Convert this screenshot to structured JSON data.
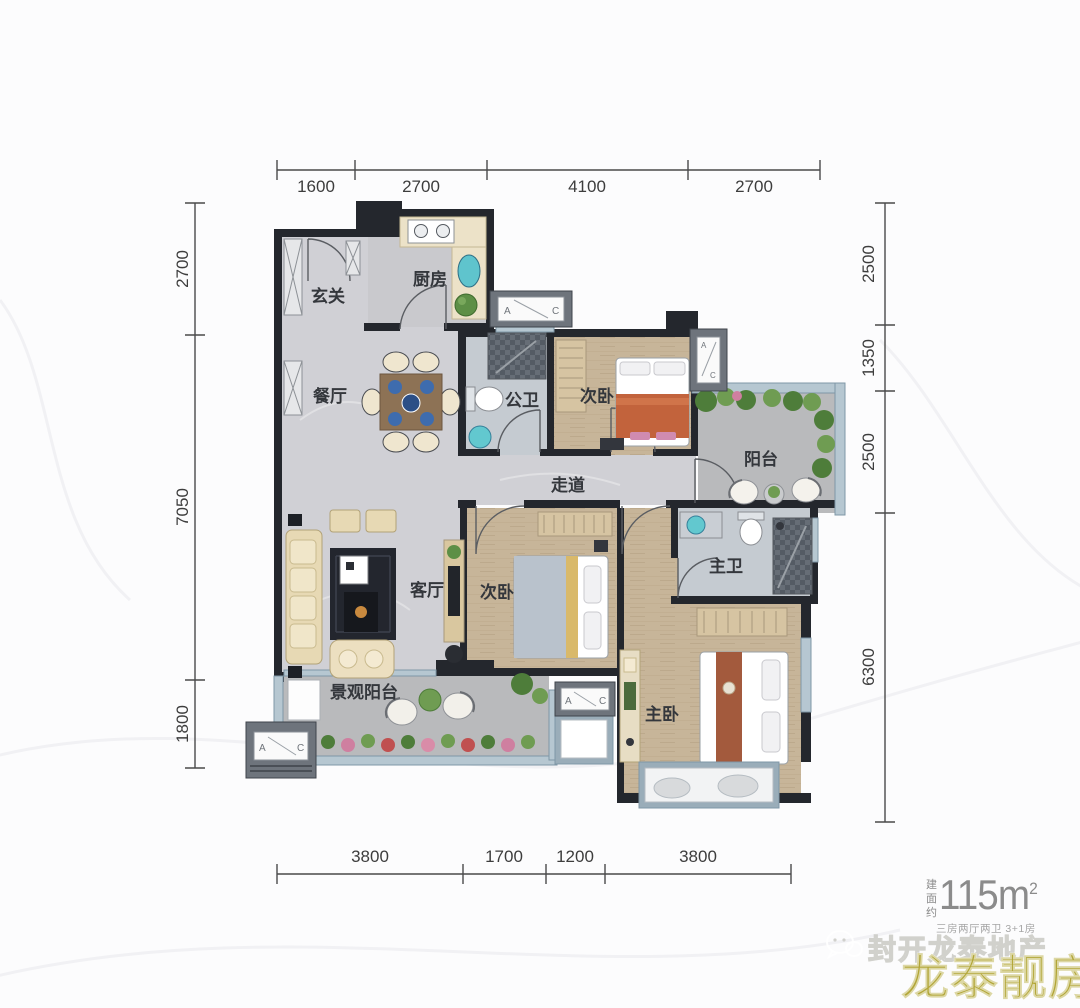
{
  "dimensions": {
    "top": [
      "1600",
      "2700",
      "4100",
      "2700"
    ],
    "left": [
      "2700",
      "7050",
      "1800"
    ],
    "right": [
      "2500",
      "1350",
      "2500",
      "6300"
    ],
    "bottom": [
      "3800",
      "1700",
      "1200",
      "3800"
    ]
  },
  "rooms": {
    "entry": "玄关",
    "kitchen": "厨房",
    "dining": "餐厅",
    "guest_bath": "公卫",
    "bedroom_top": "次卧",
    "balcony": "阳台",
    "corridor": "走道",
    "living": "客厅",
    "bedroom_mid": "次卧",
    "master_bath": "主卫",
    "master_bedroom": "主卧",
    "view_balcony": "景观阳台"
  },
  "ac": {
    "a": "A",
    "c": "C"
  },
  "branding": {
    "area_label": "建面约",
    "area_value": "115m",
    "area_sup": "2",
    "spec": "三房两厅两卫 3+1房",
    "watermark": "封开龙泰地产",
    "brand": "龙泰靓房"
  },
  "palette": {
    "wall": "#24272d",
    "window_blue": "#b6c7d1",
    "gold": "#b2a637",
    "text_gray": "#8b8b8b",
    "accent_blue": "#3e6cae",
    "wood_floor": "#c7b599",
    "marble_floor": "#d0d0d5"
  }
}
